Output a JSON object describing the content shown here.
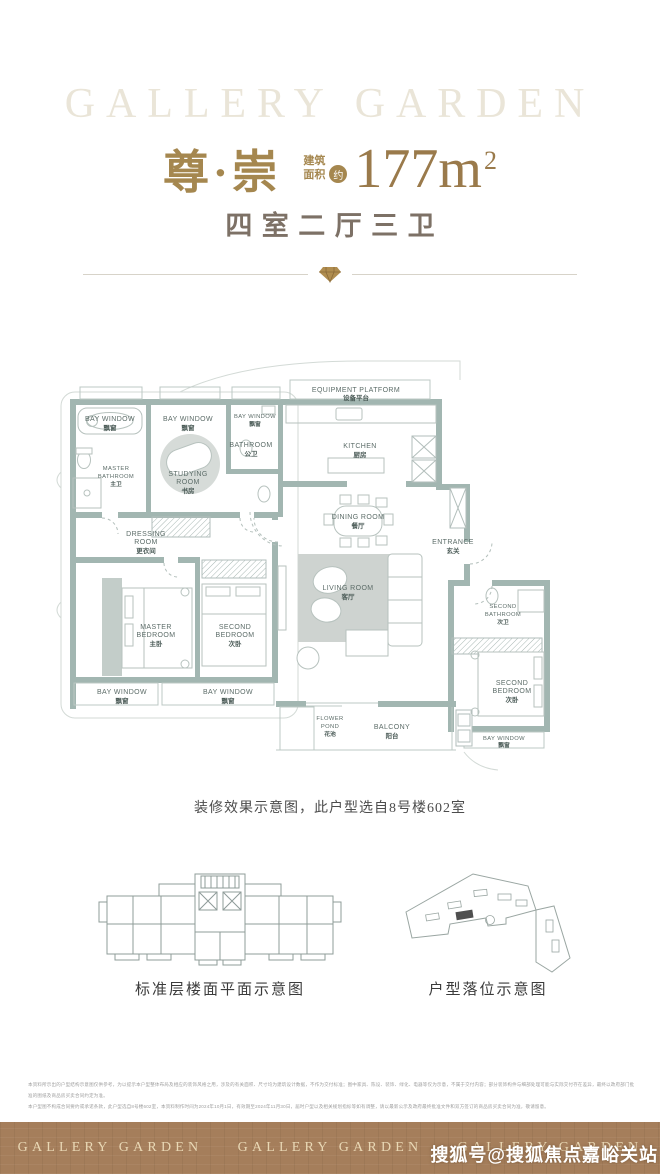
{
  "header": {
    "brand_watermark": "GALLERY GARDEN",
    "title": "尊·崇",
    "area_label_line1": "建筑",
    "area_label_line2": "面积",
    "area_approx": "约",
    "area_value": "177m",
    "area_sup": "2",
    "subtitle": "四室二厅三卫"
  },
  "floor_plan": {
    "caption": "装修效果示意图，此户型选自8号楼602室",
    "rooms": [
      {
        "name": "bay-window-1",
        "lines": [
          "BAY WINDOW",
          "飘窗"
        ]
      },
      {
        "name": "bay-window-2",
        "lines": [
          "BAY WINDOW",
          "飘窗"
        ]
      },
      {
        "name": "bay-window-3",
        "lines": [
          "BAY WINDOW",
          "飘窗"
        ]
      },
      {
        "name": "bathroom",
        "lines": [
          "BATHROOM",
          "公卫"
        ]
      },
      {
        "name": "master-bathroom",
        "lines": [
          "MASTER",
          "BATHROOM",
          "主卫"
        ]
      },
      {
        "name": "studying-room",
        "lines": [
          "STUDYING",
          "ROOM",
          "书房"
        ]
      },
      {
        "name": "equipment-platform",
        "lines": [
          "EQUIPMENT PLATFORM",
          "设备平台"
        ]
      },
      {
        "name": "kitchen",
        "lines": [
          "KITCHEN",
          "厨房"
        ]
      },
      {
        "name": "dining-room",
        "lines": [
          "DINING ROOM",
          "餐厅"
        ]
      },
      {
        "name": "entrance",
        "lines": [
          "ENTRANCE",
          "玄关"
        ]
      },
      {
        "name": "dressing-room",
        "lines": [
          "DRESSING",
          "ROOM",
          "更衣间"
        ]
      },
      {
        "name": "master-bedroom",
        "lines": [
          "MASTER",
          "BEDROOM",
          "主卧"
        ]
      },
      {
        "name": "second-bedroom",
        "lines": [
          "SECOND",
          "BEDROOM",
          "次卧"
        ]
      },
      {
        "name": "living-room",
        "lines": [
          "LIVING ROOM",
          "客厅"
        ]
      },
      {
        "name": "second-bathroom",
        "lines": [
          "SECOND",
          "BATHROOM",
          "次卫"
        ]
      },
      {
        "name": "second-bedroom-2",
        "lines": [
          "SECOND",
          "BEDROOM",
          "次卧"
        ]
      },
      {
        "name": "bay-window-4",
        "lines": [
          "BAY WINDOW",
          "飘窗"
        ]
      },
      {
        "name": "bay-window-5",
        "lines": [
          "BAY WINDOW",
          "飘窗"
        ]
      },
      {
        "name": "flower-pond",
        "lines": [
          "FLOWER",
          "POND",
          "花池"
        ]
      },
      {
        "name": "balcony",
        "lines": [
          "BALCONY",
          "阳台"
        ]
      },
      {
        "name": "bay-window-6",
        "lines": [
          "BAY WINDOW",
          "飘窗"
        ]
      }
    ]
  },
  "diagrams": {
    "left_caption": "标准层楼面平面示意图",
    "right_caption": "户型落位示意图"
  },
  "disclaimer": {
    "line1": "本资料所示出的户型结构示意图仅供参考，为以提示本户型整体布局及相应的装饰风格之用，涉及的有关面积、尺寸均为建筑设计数据，不作为交付标准；图中家具、陈设、装饰、绿化、电器等仅为示意，不属于交付内容；部分装饰构件与细部处理可能与实际交付存在差异，最终以政府部门批准的图纸及商品房买卖合同约定为准。",
    "line2": "本户型图不构成合同要约或承诺条款，此户型选自8号楼602室，本资料制作时间为2024年10月1日，有效期至2024年11月30日，届时户型以及相关规划指标等如有调整，请以最新公示及政府最终批准文件和双方签订的商品房买卖合同为准，敬请留意。"
  },
  "footer": {
    "brand": "GALLERY GARDEN",
    "watermark": "搜狐号@搜狐焦点嘉峪关站"
  },
  "colors": {
    "gold": "#a5874f",
    "area_gold": "#9a7a4b",
    "subtitle_brown": "#7d7166",
    "wall_teal": "#a2b6b1",
    "footer_brown": "#a57e5b",
    "footer_text": "#e9d8b5"
  }
}
